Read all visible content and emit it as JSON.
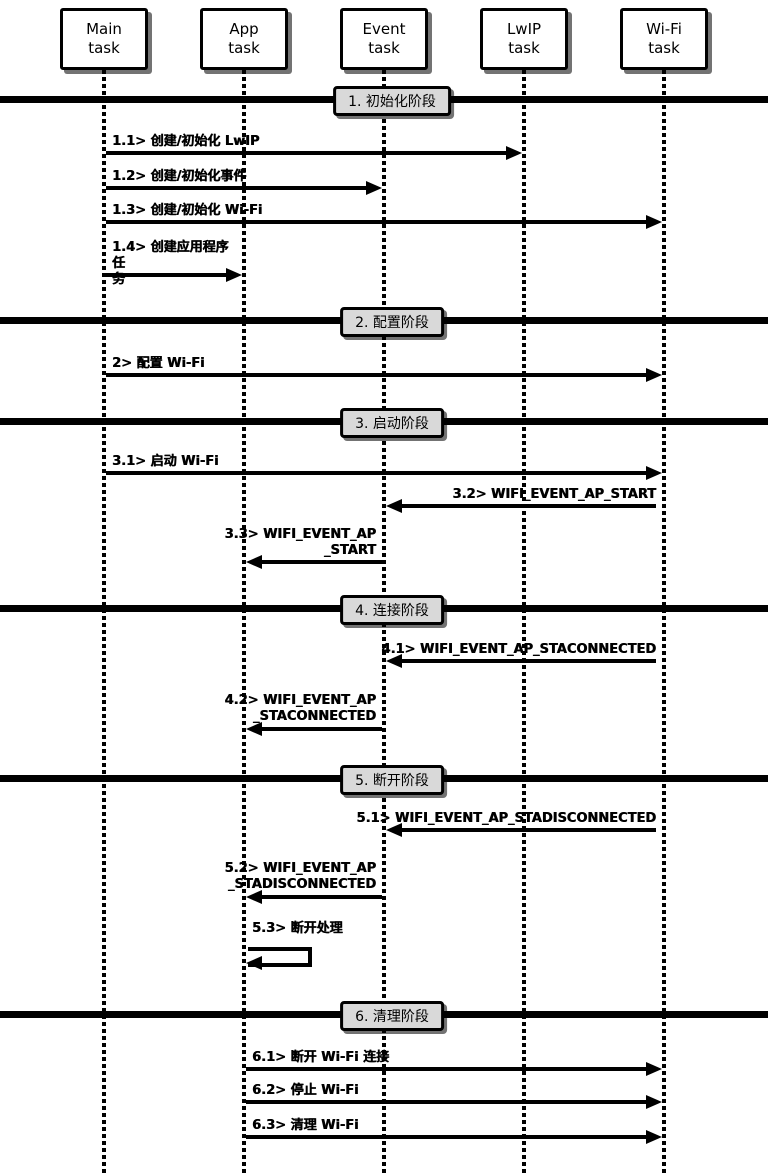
{
  "diagram": {
    "type": "sequence-diagram",
    "actors": [
      {
        "id": "main",
        "label": "Main\ntask"
      },
      {
        "id": "app",
        "label": "App\ntask"
      },
      {
        "id": "event",
        "label": "Event\ntask"
      },
      {
        "id": "lwip",
        "label": "LwIP\ntask"
      },
      {
        "id": "wifi",
        "label": "Wi-Fi\ntask"
      }
    ],
    "phases": [
      {
        "label": "1. 初始化阶段"
      },
      {
        "label": "2. 配置阶段"
      },
      {
        "label": "3. 启动阶段"
      },
      {
        "label": "4. 连接阶段"
      },
      {
        "label": "5. 断开阶段"
      },
      {
        "label": "6. 清理阶段"
      }
    ],
    "messages": [
      {
        "label": "1.1> 创建/初始化 LwIP",
        "from": "Main task",
        "to": "LwIP task"
      },
      {
        "label": "1.2> 创建/初始化事件",
        "from": "Main task",
        "to": "Event task"
      },
      {
        "label": "1.3> 创建/初始化 Wi-Fi",
        "from": "Main task",
        "to": "Wi-Fi task"
      },
      {
        "label": "1.4> 创建应用程序任\n务",
        "from": "Main task",
        "to": "App task"
      },
      {
        "label": "2> 配置 Wi-Fi",
        "from": "Main task",
        "to": "Wi-Fi task"
      },
      {
        "label": "3.1> 启动 Wi-Fi",
        "from": "Main task",
        "to": "Wi-Fi task"
      },
      {
        "label": "3.2> WIFI_EVENT_AP_START",
        "from": "Wi-Fi task",
        "to": "Event task"
      },
      {
        "label": "3.3> WIFI_EVENT_AP\n_START",
        "from": "Event task",
        "to": "App task"
      },
      {
        "label": "4.1> WIFI_EVENT_AP_STACONNECTED",
        "from": "Wi-Fi task",
        "to": "Event task"
      },
      {
        "label": "4.2> WIFI_EVENT_AP\n_STACONNECTED",
        "from": "Event task",
        "to": "App task"
      },
      {
        "label": "5.1> WIFI_EVENT_AP_STADISCONNECTED",
        "from": "Wi-Fi task",
        "to": "Event task"
      },
      {
        "label": "5.2> WIFI_EVENT_AP\n_STADISCONNECTED",
        "from": "Event task",
        "to": "App task"
      },
      {
        "label": "5.3> 断开处理",
        "from": "App task",
        "to": "App task"
      },
      {
        "label": "6.1> 断开 Wi-Fi 连接",
        "from": "App task",
        "to": "Wi-Fi task"
      },
      {
        "label": "6.2> 停止 Wi-Fi",
        "from": "App task",
        "to": "Wi-Fi task"
      },
      {
        "label": "6.3> 清理 Wi-Fi",
        "from": "App task",
        "to": "Wi-Fi task"
      }
    ],
    "colors": {
      "line": "#000000",
      "phase_label_fill": "#d9d9d9",
      "actor_fill": "#ffffff",
      "background": "#ffffff"
    }
  }
}
